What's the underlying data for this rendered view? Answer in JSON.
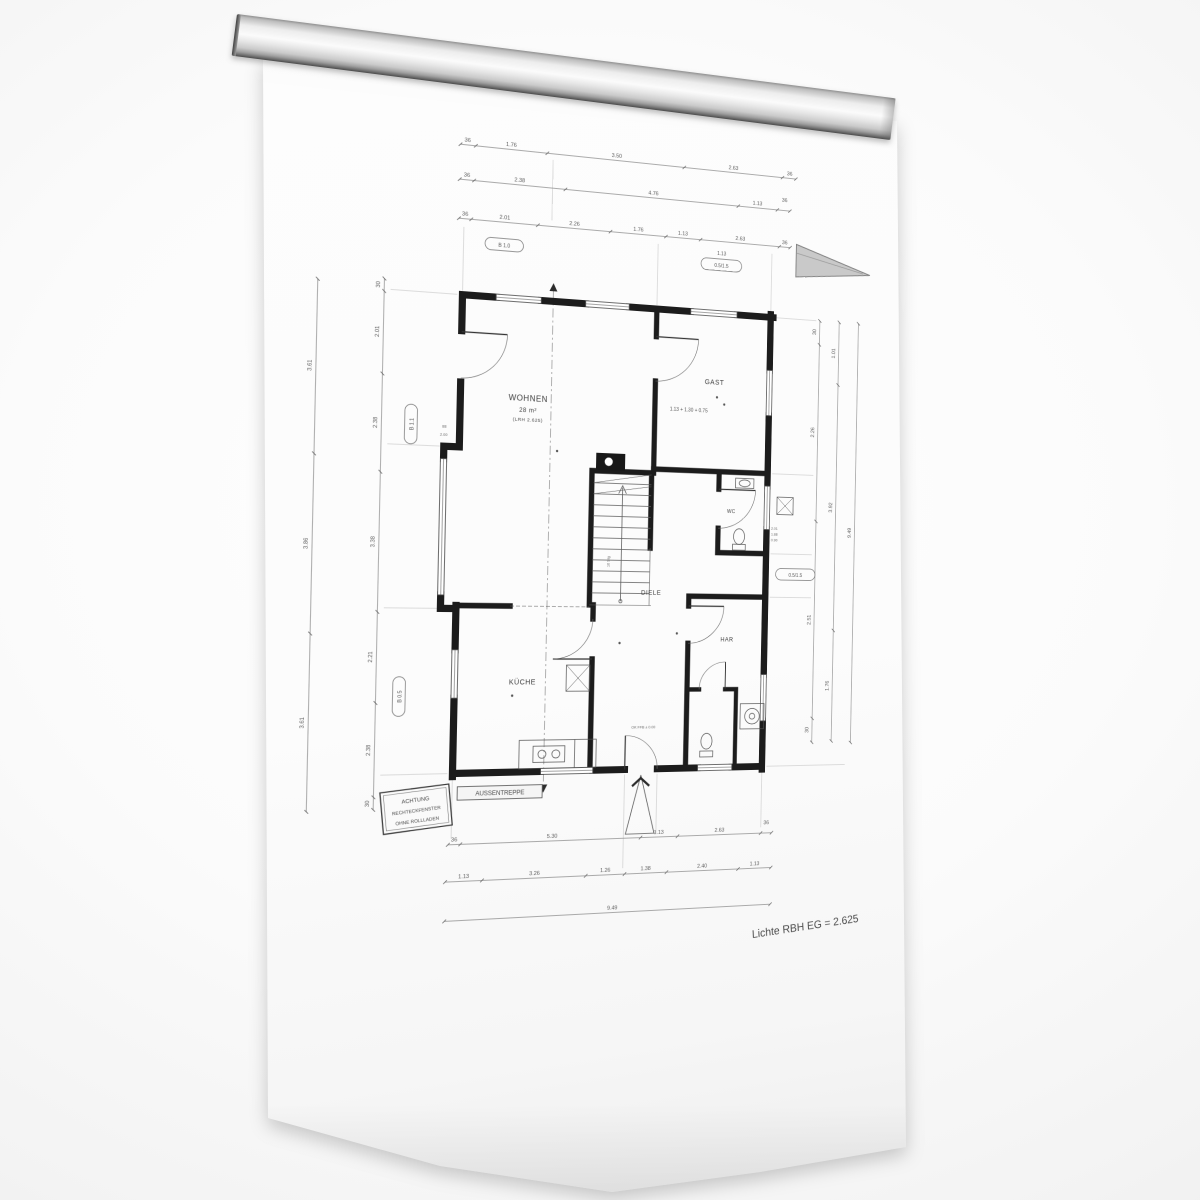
{
  "scene": {
    "description": "floor plan drawing on white sheet held by wall-mounted metal clamp rail",
    "rail_color": "#d9d9d9",
    "paper_color": "#fcfcfc",
    "line_color": "#1c1c1c"
  },
  "plan": {
    "rooms": {
      "wohnen": {
        "label": "WOHNEN",
        "area": "28 m²",
        "note": "(LRH 2.625)"
      },
      "gast": {
        "label": "GAST"
      },
      "diele": {
        "label": "DIELE"
      },
      "kueche": {
        "label": "KÜCHE"
      },
      "har": {
        "label": "HAR"
      },
      "wc": {
        "label": "WC"
      }
    },
    "stairs_label": "16 Stg",
    "center_note": "1.13 + 1.30 + 0.75",
    "entry_note": "OK FFB ± 0.00",
    "aussentreppe_label": "AUSSENTREPPE",
    "warning_box": {
      "lines": [
        "ACHTUNG",
        "RECHTECKFENSTER",
        "OHNE ROLLLADEN"
      ]
    },
    "footer_note": "Lichte RBH EG = 2.625",
    "side_notes": [
      "2.01",
      "1.88",
      "0.90"
    ],
    "tags": {
      "t1": "B 1.0",
      "t2": "0.5/1.5",
      "t3": "B 1.1",
      "t4": "B 0.5",
      "t5": "1.13",
      "t6": "0.5/1.5"
    },
    "dims": {
      "top1": [
        "36",
        "1.76",
        "3.50",
        "2.63",
        "36"
      ],
      "top2": [
        "36",
        "2.38",
        "4.76",
        "1.13",
        "36"
      ],
      "top3": [
        "36",
        "2.01",
        "2.26",
        "1.76",
        "1.13",
        "2.63",
        "36"
      ],
      "bottom1": [
        "36",
        "5.30",
        "1.13",
        "2.63",
        "36"
      ],
      "bottom2": [
        "1.13",
        "3.26",
        "1.26",
        "1.38",
        "2.40",
        "1.13"
      ],
      "bottom3": [
        "9.49"
      ],
      "left1": [
        "3.61",
        "3.86",
        "3.61"
      ],
      "left2": [
        "30",
        "2.01",
        "2.38",
        "3.38",
        "2.21",
        "2.38",
        "30"
      ],
      "left_sub": [
        "88",
        "2.00"
      ],
      "right1": [
        "30",
        "2.26",
        "2.51",
        "30"
      ],
      "right2": [
        "1.01",
        "3.92",
        "1.76"
      ],
      "right3": [
        "9.49"
      ]
    }
  }
}
